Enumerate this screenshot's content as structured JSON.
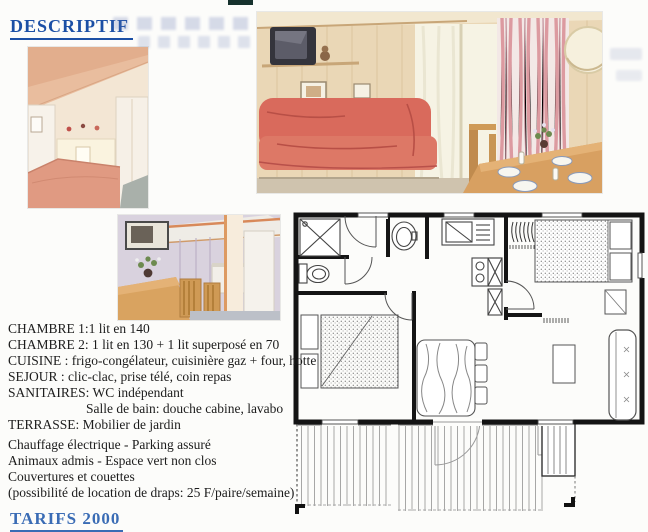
{
  "document": {
    "title": "DESCRIPTIF",
    "footer_section_title": "TARIFS 2000"
  },
  "specs": {
    "lines": [
      "CHAMBRE 1:1 lit en 140",
      "CHAMBRE 2: 1 lit en 130 + 1 lit superposé en 70",
      "CUISINE : frigo-congélateur, cuisinière gaz + four, hotte",
      "SEJOUR : clic-clac, prise télé, coin repas",
      "SANITAIRES: WC indépendant",
      "Salle de bain: douche cabine, lavabo",
      "TERRASSE: Mobilier de jardin"
    ]
  },
  "amenities": {
    "lines": [
      "Chauffage électrique - Parking assuré",
      "Animaux admis - Espace vert non clos",
      "Couvertures et couettes",
      "(possibilité de location de draps: 25 F/paire/semaine)"
    ]
  },
  "colors": {
    "heading_blue": "#1b4fa5",
    "sofa_red": "#d96a5c",
    "wood_panel": "#ead7b6",
    "bed_salmon": "#e09a82",
    "plan_wall_black": "#141414"
  }
}
